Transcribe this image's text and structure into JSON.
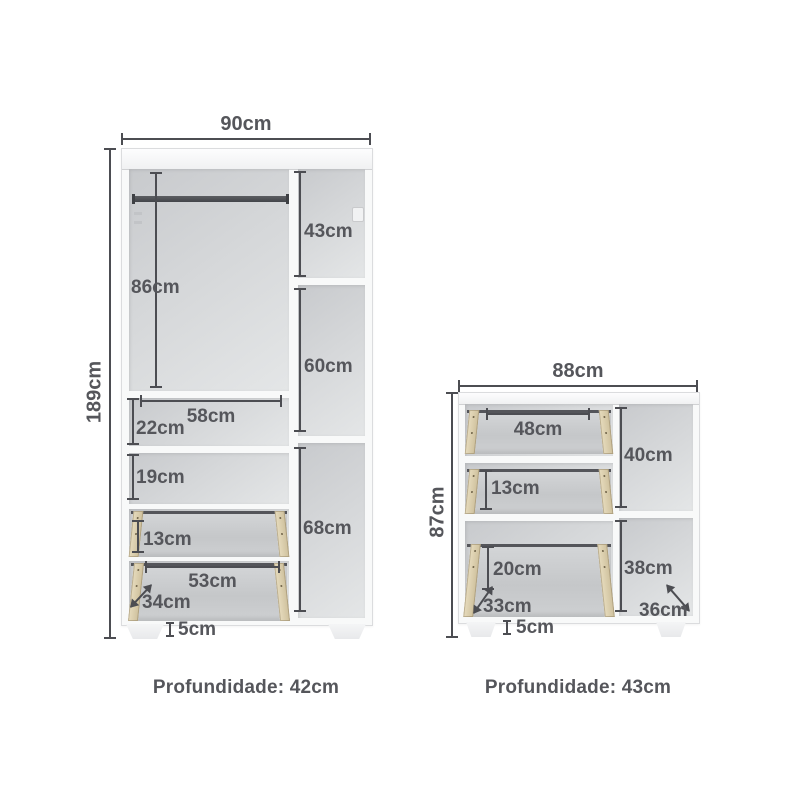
{
  "wardrobe": {
    "width": "90cm",
    "height": "189cm",
    "interior": {
      "hanging_height": "86cm",
      "shelf_width": "58cm",
      "upper_section_height": "22cm",
      "middle_section_height": "19cm",
      "small_drawer_height": "13cm",
      "large_drawer_width": "53cm",
      "large_drawer_depth": "34cm",
      "side_top_height": "43cm",
      "side_middle_height": "60cm",
      "side_bottom_height": "68cm"
    },
    "feet_height": "5cm",
    "depth": "Profundidade: 42cm"
  },
  "dresser": {
    "width": "88cm",
    "height": "87cm",
    "interior": {
      "top_drawer_width": "48cm",
      "middle_drawer_height": "13cm",
      "bottom_drawer_height": "20cm",
      "bottom_drawer_depth": "33cm",
      "side_top_height": "40cm",
      "side_bottom_height": "38cm",
      "base_depth": "36cm"
    },
    "feet_height": "5cm",
    "depth": "Profundidade: 43cm"
  },
  "colors": {
    "background": "#ffffff",
    "dimension_line": "#4c4d52",
    "label_text": "#55565b",
    "cabinet_white": "#f8f9f9",
    "interior_gray_dark": "#c8cacd",
    "interior_gray_light": "#e4e6e7",
    "drawer_rail_beige": "#d8c9a9",
    "rod_dark": "#4a4c50"
  }
}
